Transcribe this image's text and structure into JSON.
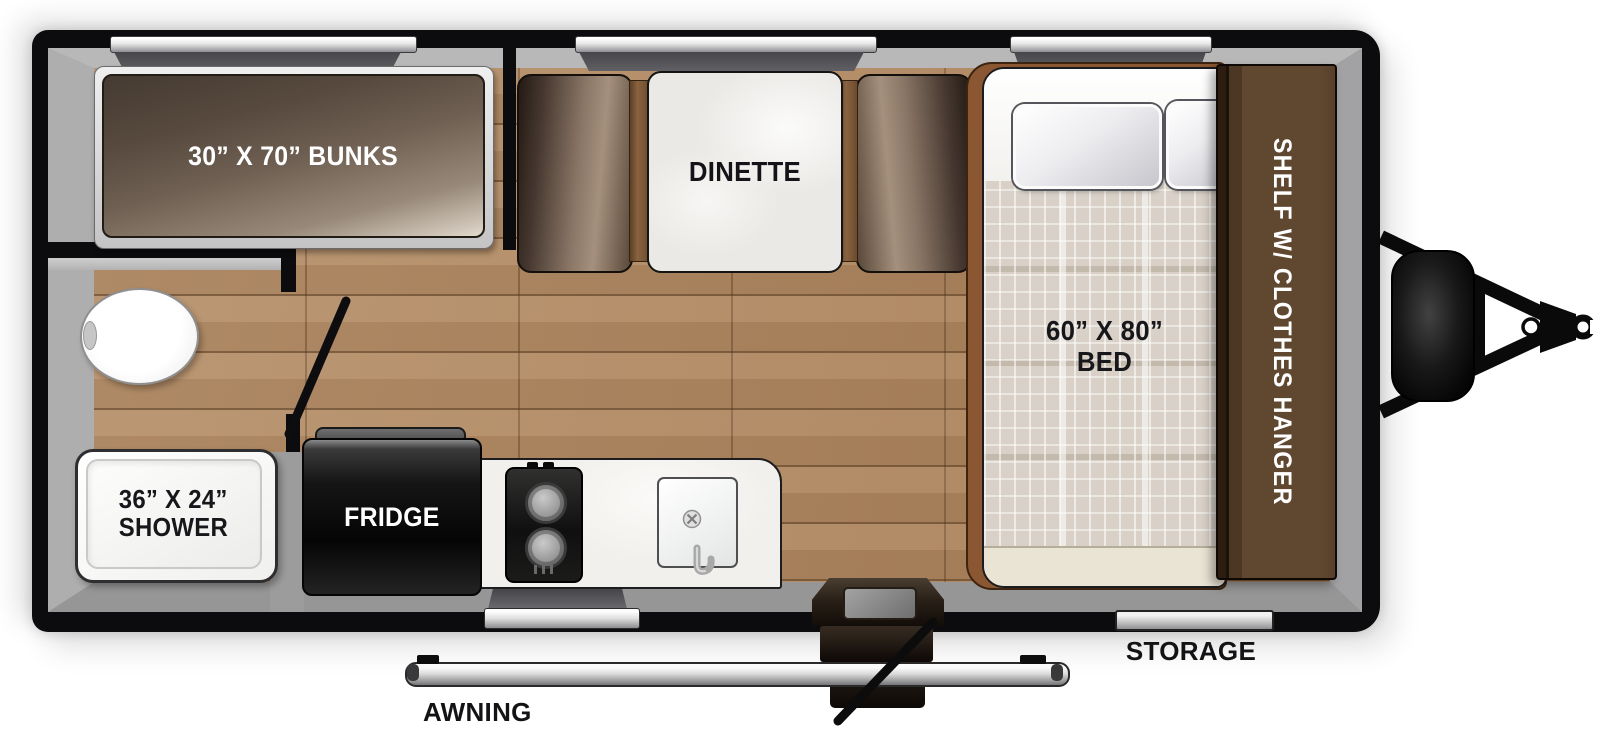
{
  "colors": {
    "wall": "#0c0c0e",
    "interior_grey": "#a8a8a8",
    "floor_wood": "#b18a62",
    "furniture_brown": "#604830",
    "counter_white": "#f1f0ed",
    "label_dark": "#131316",
    "label_light": "#ffffff"
  },
  "rooms": {
    "bunks": {
      "label": "30” X 70” BUNKS"
    },
    "dinette": {
      "label": "DINETTE"
    },
    "bed": {
      "size": "60” X 80”",
      "name": "BED"
    },
    "shelf": {
      "label": "SHELF W/ CLOTHES HANGER"
    },
    "shower": {
      "size": "36” X 24”",
      "name": "SHOWER"
    },
    "kitchen": {
      "fridge_label": "FRIDGE"
    },
    "exterior": {
      "storage_label": "STORAGE",
      "awning_label": "AWNING"
    }
  }
}
